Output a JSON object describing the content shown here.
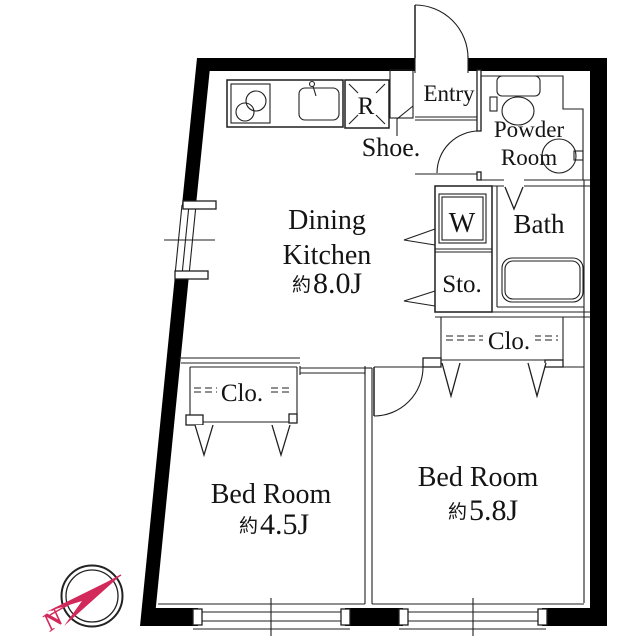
{
  "title": "2DK apartment floor plan",
  "colors": {
    "background": "#ffffff",
    "wall": "#000000",
    "line": "#1f1f1f",
    "text": "#141414",
    "compass_accent": "#d2285a"
  },
  "rooms": {
    "entry": {
      "label": "Entry"
    },
    "shoe_cabinet": {
      "label": "Shoe."
    },
    "refrigerator": {
      "label": "R"
    },
    "dining_kitchen": {
      "line1": "Dining",
      "line2": "Kitchen",
      "area_prefix": "約",
      "area": "8.0J"
    },
    "powder_room": {
      "line1": "Powder",
      "line2": "Room"
    },
    "washer": {
      "label": "W"
    },
    "storage": {
      "label": "Sto."
    },
    "bath": {
      "label": "Bath"
    },
    "closet_right": {
      "label": "Clo."
    },
    "closet_left": {
      "label": "Clo."
    },
    "bedroom_small": {
      "name": "Bed Room",
      "area_prefix": "約",
      "area": "4.5J"
    },
    "bedroom_large": {
      "name": "Bed Room",
      "area_prefix": "約",
      "area": "5.8J"
    }
  },
  "compass": {
    "north_label": "N"
  }
}
